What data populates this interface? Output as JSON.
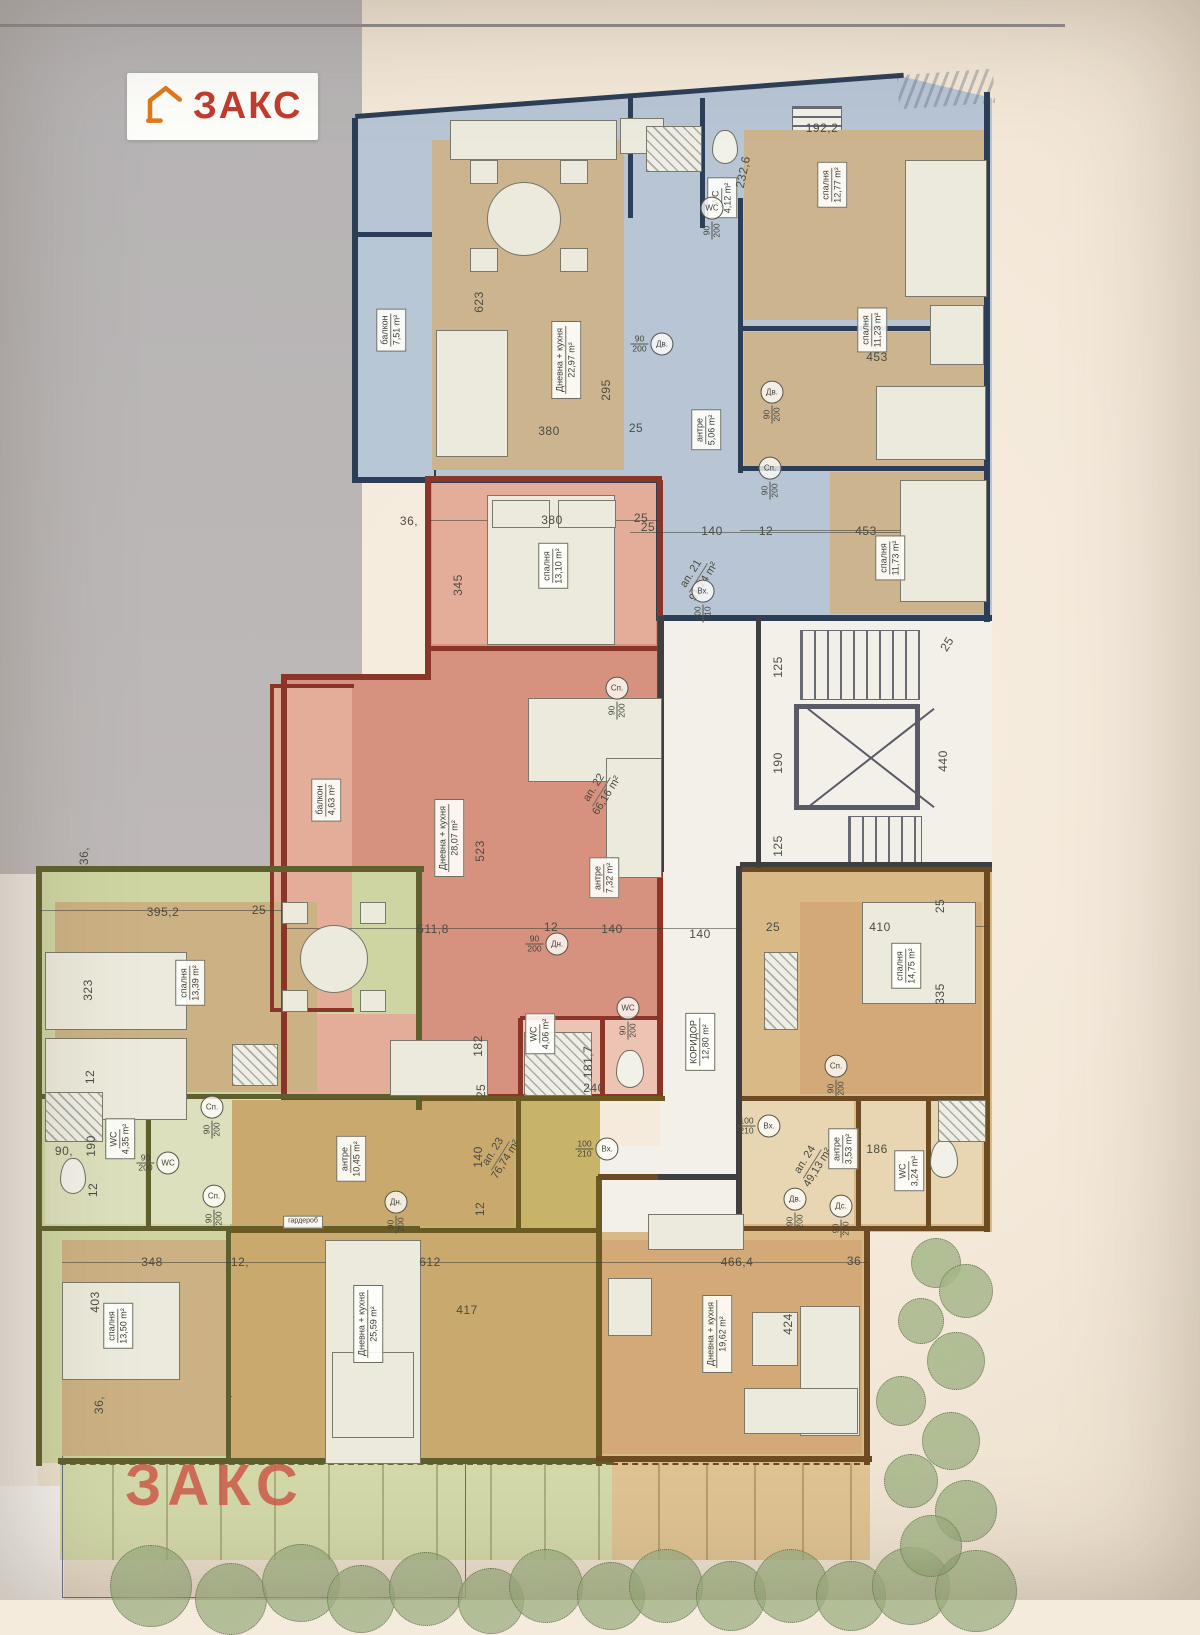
{
  "logo": {
    "text": "ЗАКС"
  },
  "watermark": {
    "text": "ЗАКС"
  },
  "palette": {
    "paper": "#f5ebdd",
    "photo_gray": "#b2afb1",
    "blue_fill": "#b7c5d5",
    "blue_wall": "#2c3e57",
    "blue_floor": "#ccb58e",
    "red_fill": "#d6927e",
    "red_light": "#e4ad99",
    "red_wall": "#8a3527",
    "wc_pink": "#edc4b3",
    "green_fill": "#ced5a2",
    "green_wall": "#5f5f2d",
    "green_floor": "#cbb183",
    "green_light": "#dde0bc",
    "olive_fill": "#c8b469",
    "olive_floor": "#c9a96d",
    "olive_wall": "#6a5a22",
    "tan_fill": "#d9b986",
    "tan_floor": "#d2a977",
    "tan_light": "#e8d6b2",
    "tan_wall": "#6d4b22",
    "white_zone": "#f3f0e9",
    "wall_dark": "#3f3f3f",
    "dim_text": "#4c4c44",
    "logo_red": "#c23b2e",
    "logo_orange": "#e07818",
    "watermark_red": "#cd5b49",
    "tree": "#8aa06d",
    "terrace_green": "#d3d9a9",
    "terrace_tan": "#dfc392"
  },
  "room_labels": [
    {
      "room": "балкон",
      "area": "7,51 m²",
      "x": 391,
      "y": 330,
      "rot": -90
    },
    {
      "room": "Дневна + кухня",
      "area": "22,97 m²",
      "x": 566,
      "y": 360,
      "rot": -90
    },
    {
      "room": "WC",
      "area": "4,12 m²",
      "x": 722,
      "y": 198,
      "rot": -90
    },
    {
      "room": "антре",
      "area": "5,06 m²",
      "x": 706,
      "y": 430,
      "rot": -90
    },
    {
      "room": "спалня",
      "area": "12,77 m²",
      "x": 832,
      "y": 185,
      "rot": -90
    },
    {
      "room": "спалня",
      "area": "11,23 m²",
      "x": 872,
      "y": 330,
      "rot": -90
    },
    {
      "room": "спалня",
      "area": "11,73 m²",
      "x": 890,
      "y": 558,
      "rot": -90
    },
    {
      "room": "ап. 21",
      "area": "91,74 m²",
      "x": 698,
      "y": 578,
      "rot": -58,
      "plain": true
    },
    {
      "room": "спалня",
      "area": "13,10 m²",
      "x": 553,
      "y": 566,
      "rot": -90
    },
    {
      "room": "балкон",
      "area": "4,63 m²",
      "x": 326,
      "y": 800,
      "rot": -90
    },
    {
      "room": "Дневна + кухня",
      "area": "28,07 m²",
      "x": 449,
      "y": 838,
      "rot": -90
    },
    {
      "room": "антре",
      "area": "7,32 m²",
      "x": 604,
      "y": 878,
      "rot": -90
    },
    {
      "room": "ап. 22",
      "area": "66,16 m²",
      "x": 601,
      "y": 792,
      "rot": -58,
      "plain": true
    },
    {
      "room": "WC",
      "area": "4,06 m²",
      "x": 540,
      "y": 1034,
      "rot": -90
    },
    {
      "room": "КОРИДОР",
      "area": "12,80 m²",
      "x": 700,
      "y": 1042,
      "rot": -90
    },
    {
      "room": "спалня",
      "area": "13,39 m²",
      "x": 190,
      "y": 983,
      "rot": -90
    },
    {
      "room": "WC",
      "area": "4,35 m²",
      "x": 120,
      "y": 1139,
      "rot": -90
    },
    {
      "room": "антре",
      "area": "10,45 m²",
      "x": 351,
      "y": 1159,
      "rot": -90
    },
    {
      "room": "ап. 23",
      "area": "76,74 m²",
      "x": 500,
      "y": 1156,
      "rot": -58,
      "plain": true
    },
    {
      "room": "гардероб",
      "area": "",
      "x": 303,
      "y": 1222,
      "rot": 0,
      "tiny": true
    },
    {
      "room": "Дневна + кухня",
      "area": "25,59 m²",
      "x": 368,
      "y": 1324,
      "rot": -90
    },
    {
      "room": "спалня",
      "area": "13,50 m²",
      "x": 118,
      "y": 1326,
      "rot": -90
    },
    {
      "room": "спалня",
      "area": "14,75 m²",
      "x": 906,
      "y": 966,
      "rot": -90
    },
    {
      "room": "антре",
      "area": "3,53 m²",
      "x": 843,
      "y": 1149,
      "rot": -90
    },
    {
      "room": "WC",
      "area": "3,24 m²",
      "x": 909,
      "y": 1171,
      "rot": -90
    },
    {
      "room": "ап. 24",
      "area": "49,13 m²",
      "x": 812,
      "y": 1164,
      "rot": -58,
      "plain": true
    },
    {
      "room": "Дневна + кухня",
      "area": "19,62 m²",
      "x": 717,
      "y": 1334,
      "rot": -90
    }
  ],
  "dimensions": [
    {
      "t": "623",
      "x": 479,
      "y": 302,
      "r": -90
    },
    {
      "t": "295",
      "x": 606,
      "y": 390,
      "r": -90
    },
    {
      "t": "380",
      "x": 549,
      "y": 431
    },
    {
      "t": "25",
      "x": 636,
      "y": 428
    },
    {
      "t": "232,6",
      "x": 743,
      "y": 172,
      "r": -78
    },
    {
      "t": "192,2",
      "x": 822,
      "y": 128
    },
    {
      "t": "453",
      "x": 877,
      "y": 357
    },
    {
      "t": "25",
      "x": 648,
      "y": 527
    },
    {
      "t": "140",
      "x": 712,
      "y": 531
    },
    {
      "t": "12",
      "x": 766,
      "y": 531
    },
    {
      "t": "453",
      "x": 866,
      "y": 531
    },
    {
      "t": "36,",
      "x": 409,
      "y": 521
    },
    {
      "t": "380",
      "x": 552,
      "y": 520
    },
    {
      "t": "25",
      "x": 641,
      "y": 518
    },
    {
      "t": "345",
      "x": 458,
      "y": 585,
      "r": -90
    },
    {
      "t": "523",
      "x": 480,
      "y": 851,
      "r": -90
    },
    {
      "t": "511,8",
      "x": 433,
      "y": 929
    },
    {
      "t": "12",
      "x": 551,
      "y": 927
    },
    {
      "t": "140",
      "x": 612,
      "y": 929
    },
    {
      "t": "140",
      "x": 700,
      "y": 934
    },
    {
      "t": "182",
      "x": 478,
      "y": 1046,
      "r": -90
    },
    {
      "t": "25",
      "x": 481,
      "y": 1091,
      "r": -90
    },
    {
      "t": "181,7",
      "x": 588,
      "y": 1062,
      "r": -90
    },
    {
      "t": "240",
      "x": 594,
      "y": 1088
    },
    {
      "t": "125",
      "x": 778,
      "y": 667,
      "r": -90
    },
    {
      "t": "190",
      "x": 778,
      "y": 763,
      "r": -90
    },
    {
      "t": "125",
      "x": 778,
      "y": 846,
      "r": -90
    },
    {
      "t": "440",
      "x": 943,
      "y": 761,
      "r": -90
    },
    {
      "t": "25",
      "x": 947,
      "y": 644,
      "r": -58
    },
    {
      "t": "36,",
      "x": 84,
      "y": 856,
      "r": -90
    },
    {
      "t": "395,2",
      "x": 163,
      "y": 912
    },
    {
      "t": "25",
      "x": 259,
      "y": 910
    },
    {
      "t": "323",
      "x": 88,
      "y": 990,
      "r": -90
    },
    {
      "t": "12",
      "x": 90,
      "y": 1077,
      "r": -90
    },
    {
      "t": "190",
      "x": 91,
      "y": 1146,
      "r": -90
    },
    {
      "t": "12",
      "x": 93,
      "y": 1190,
      "r": -90
    },
    {
      "t": "90,",
      "x": 64,
      "y": 1151
    },
    {
      "t": "140",
      "x": 478,
      "y": 1157,
      "r": -90
    },
    {
      "t": "12",
      "x": 480,
      "y": 1209,
      "r": -90
    },
    {
      "t": "348",
      "x": 152,
      "y": 1262
    },
    {
      "t": "12,",
      "x": 240,
      "y": 1262
    },
    {
      "t": "612",
      "x": 430,
      "y": 1262
    },
    {
      "t": "466,4",
      "x": 737,
      "y": 1262
    },
    {
      "t": "36",
      "x": 854,
      "y": 1261
    },
    {
      "t": "403",
      "x": 95,
      "y": 1302,
      "r": -90
    },
    {
      "t": "417",
      "x": 467,
      "y": 1310
    },
    {
      "t": "424",
      "x": 788,
      "y": 1324,
      "r": -90
    },
    {
      "t": "36,",
      "x": 99,
      "y": 1405,
      "r": -90
    },
    {
      "t": "410",
      "x": 880,
      "y": 927
    },
    {
      "t": "25",
      "x": 773,
      "y": 927
    },
    {
      "t": "25",
      "x": 940,
      "y": 906,
      "r": -90
    },
    {
      "t": "335",
      "x": 940,
      "y": 994,
      "r": -90
    },
    {
      "t": "186",
      "x": 877,
      "y": 1149
    }
  ],
  "door_tags": [
    {
      "f": "90/200",
      "l": "Дв.",
      "x": 652,
      "y": 344
    },
    {
      "f": "90/200",
      "l": "WC",
      "x": 712,
      "y": 218,
      "v": 1
    },
    {
      "f": "90/200",
      "l": "Дв.",
      "x": 772,
      "y": 402,
      "v": 1
    },
    {
      "f": "90/200",
      "l": "Сп.",
      "x": 770,
      "y": 478,
      "v": 1
    },
    {
      "f": "100/210",
      "l": "Вх.",
      "x": 703,
      "y": 601,
      "v": 1
    },
    {
      "f": "90/200",
      "l": "Сп.",
      "x": 617,
      "y": 698,
      "v": 1
    },
    {
      "f": "90/200",
      "l": "Дн.",
      "x": 547,
      "y": 944
    },
    {
      "f": "90/200",
      "l": "WC",
      "x": 628,
      "y": 1018,
      "v": 1
    },
    {
      "f": "100/210",
      "l": "Вх.",
      "x": 759,
      "y": 1126
    },
    {
      "f": "100/210",
      "l": "Вх.",
      "x": 597,
      "y": 1149
    },
    {
      "f": "90/200",
      "l": "Сп.",
      "x": 212,
      "y": 1117,
      "v": 1
    },
    {
      "f": "90/200",
      "l": "Сп.",
      "x": 214,
      "y": 1206,
      "v": 1
    },
    {
      "f": "90/200",
      "l": "WC",
      "x": 158,
      "y": 1163
    },
    {
      "f": "90/200",
      "l": "Дн.",
      "x": 396,
      "y": 1212,
      "v": 1
    },
    {
      "f": "90/200",
      "l": "Сп.",
      "x": 836,
      "y": 1076,
      "v": 1
    },
    {
      "f": "90/200",
      "l": "Дс.",
      "x": 841,
      "y": 1216,
      "v": 1
    },
    {
      "f": "90/200",
      "l": "Дв.",
      "x": 795,
      "y": 1209,
      "v": 1
    }
  ]
}
